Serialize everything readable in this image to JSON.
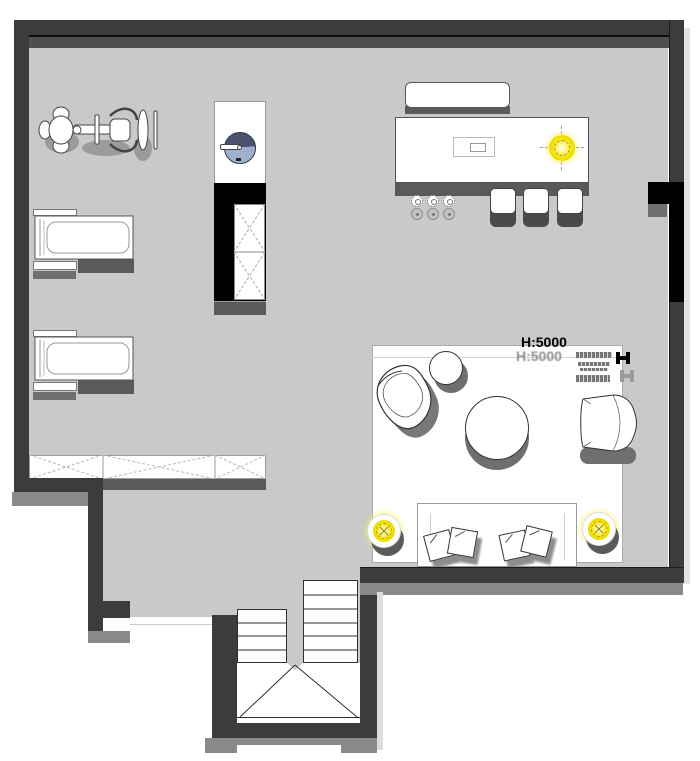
{
  "plan": {
    "ceiling_height_label": "H:5000",
    "colors": {
      "floor": "#c9c9c9",
      "wall": "#3c3c3c",
      "wall_accent": "#4f4f4f",
      "wall_black": "#000000",
      "furniture_shadow": "#5f5f5f",
      "outer_shadow": "#8a8a8a",
      "outline": "#333333",
      "light_yellow": "#f2e400",
      "light_ring": "#b89a00",
      "sink_dark": "#4a546e",
      "sink_light": "#9fb1cc"
    },
    "items": [
      "spin-bike",
      "treadmill",
      "washbasin-cabinet",
      "wardrobe-x-panel",
      "storage-bench",
      "bar-shelf",
      "bar-counter",
      "bar-sink",
      "bar-stool",
      "cup",
      "ceiling-downlight",
      "rug",
      "lounge-chair",
      "side-stool",
      "round-ottoman",
      "armchair",
      "sofa",
      "cushion",
      "floor-spotlight",
      "staircase",
      "watermark-logo"
    ]
  }
}
